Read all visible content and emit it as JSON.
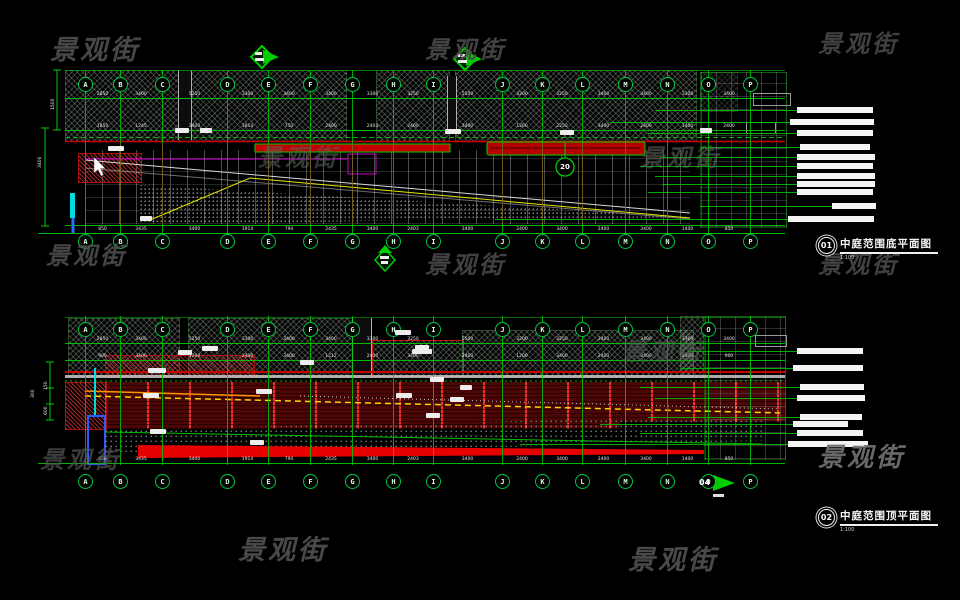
{
  "watermark": {
    "text": "景观街"
  },
  "grid": {
    "letters": [
      "A",
      "B",
      "C",
      "D",
      "E",
      "F",
      "G",
      "H",
      "I",
      "J",
      "K",
      "L",
      "M",
      "N",
      "O",
      "P"
    ]
  },
  "drawing1": {
    "title": {
      "number": "01",
      "text": "中庭范围底平面图",
      "scale": "1:100"
    },
    "detail_bubble": "20",
    "left_dims": [
      "3400",
      "1500"
    ],
    "dims_top": [
      "2850",
      "3400",
      "5250",
      "3300",
      "3400",
      "3400",
      "3300",
      "3250",
      "5500",
      "3200",
      "3250",
      "3400",
      "3400",
      "3300",
      "3400"
    ],
    "dims_mid": [
      "1850",
      "1245",
      "3400",
      "1914",
      "750",
      "2400",
      "2403",
      "2400",
      "3400",
      "1200",
      "2250",
      "3400",
      "2400",
      "1400",
      "2400"
    ],
    "dims_bottom": [
      "850",
      "3435",
      "3400",
      "1914",
      "794",
      "2435",
      "3400",
      "2403",
      "3400",
      "2400",
      "3400",
      "2400",
      "3400",
      "1400",
      "850"
    ]
  },
  "drawing2": {
    "title": {
      "number": "02",
      "text": "中庭范围顶平面图",
      "scale": "1:100"
    },
    "marker": "04",
    "left_dims": [
      "300",
      "150",
      "600"
    ],
    "dims_top": [
      "2850",
      "3400",
      "5250",
      "3300",
      "3400",
      "3400",
      "3300",
      "3250",
      "5500",
      "3200",
      "3250",
      "3400",
      "3400",
      "3300",
      "3400"
    ],
    "dims_mid": [
      "900",
      "3400",
      "1200",
      "2400",
      "3400",
      "1212",
      "2400",
      "3400",
      "2400",
      "1200",
      "3400",
      "2400",
      "3400",
      "1400",
      "900"
    ],
    "dims_bottom": [
      "850",
      "3435",
      "3400",
      "1914",
      "794",
      "2435",
      "3400",
      "2403",
      "3400",
      "2400",
      "3400",
      "2400",
      "3400",
      "1400",
      "850"
    ]
  },
  "colors": {
    "grid_green": "#00cc00",
    "line_red": "#cc0000",
    "accent_yellow": "#e6e600",
    "accent_magenta": "#dd00dd",
    "accent_cyan": "#00dde0",
    "label_white": "#f2f2f2"
  }
}
